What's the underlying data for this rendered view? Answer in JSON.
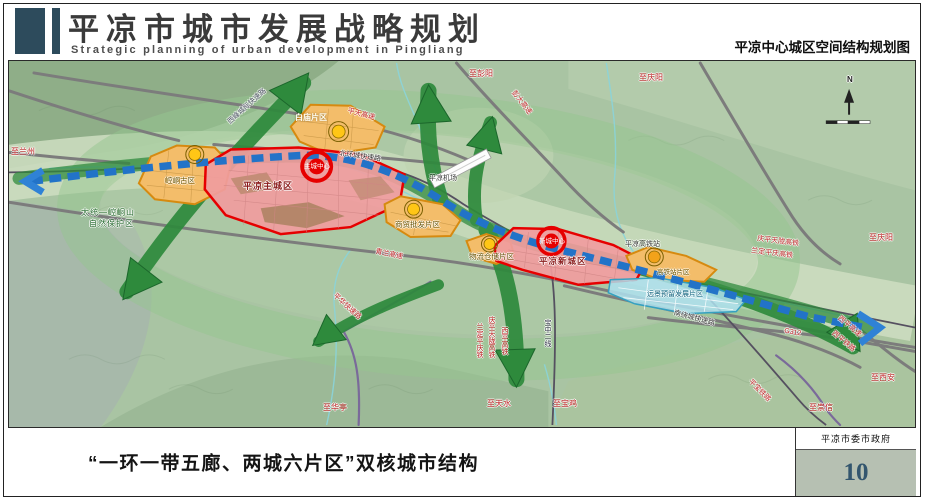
{
  "header": {
    "title_cn": "平凉市城市发展战略规划",
    "title_en": "Strategic planning of urban development in Pingliang",
    "map_title": "平凉中心城区空间结构规划图"
  },
  "map": {
    "compass": "N",
    "labels": {
      "zhi_lanzhou": "至兰州",
      "reserve_line1": "太统—崆峒山",
      "reserve_line2": "自然保护区",
      "xifeng_intercity": "西峰城际快速路",
      "baimiao": "白庙片区",
      "pingtian_expwy": "平天高速",
      "beihuan_expwy": "北环城快速路",
      "airport": "平凉机场",
      "zhi_pengyang": "至彭阳",
      "pengda_expwy": "彭大高速",
      "zhi_qingyang_top": "至庆阳",
      "kongtong_old": "崆峒古区",
      "main_city": "平凉主城区",
      "main_center": "主城中心",
      "qinglan_expwy": "青兰高速",
      "shangmao_district": "商贸批发片区",
      "wuliu_district": "物流仓储片区",
      "new_city": "平凉新城区",
      "new_center": "新城中心",
      "hsr_station": "平凉高铁站",
      "hsr_district": "高铁站片区",
      "reserve_district": "远景预留发展片区",
      "qingpingtianlong_rail": "庆平天陇高铁",
      "landingpingqing_rail": "兰定平庆高铁",
      "zhi_qingyang_right": "至庆阳",
      "nanrao_expwy": "南绕城快速路",
      "g312": "G312",
      "xiping_expwy": "西平高速",
      "xiping_rail": "西平铁路",
      "zhi_xian": "至西安",
      "zhi_chongxin": "至崇信",
      "pingbao_rail": "平宝铁路",
      "pinghua_expwy": "平华快速路",
      "zhi_huating": "至华亭",
      "v_rail_landing": "兰定平庆铁",
      "v_rail_qptl": "庆平天陇高铁",
      "v_rail_xiping": "西平高铁",
      "v_rail_baozhong": "宝中二线",
      "zhi_tianshui": "至天水",
      "zhi_baoji": "至宝鸡"
    },
    "colors": {
      "corridor_green": "#2e8a3c",
      "belt_blue": "#2273c8",
      "city_red": "#e60000",
      "district_orange": "#f3bd6a",
      "district_pink": "#f09c9e",
      "reserve_blue": "#aee0ee",
      "node_yellow": "#ffc616",
      "header_accent": "#2d4b5c"
    }
  },
  "footer": {
    "caption": "“一环一带五廊、两城六片区”双核城市结构",
    "credit": "平凉市委市政府",
    "page_number": "10"
  }
}
